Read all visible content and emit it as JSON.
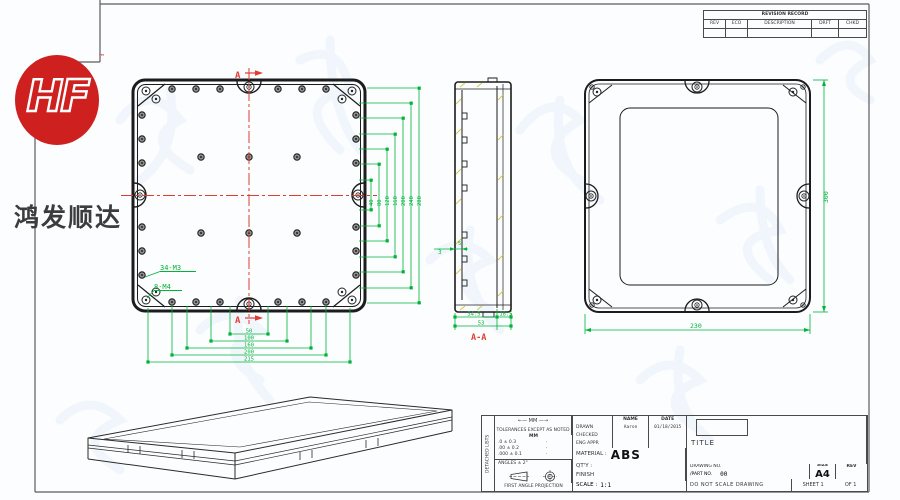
{
  "logo": {
    "brand_text": "HF",
    "brand_tm": "™",
    "company_name_cn": "鸿发顺达",
    "brand_color": "#cf2020"
  },
  "colors": {
    "dimension_green": "#00b339",
    "centerline_red": "#e23b32",
    "hatch_yellow": "#d6ca3c",
    "line_black": "#1c1c1c"
  },
  "revision_table": {
    "title": "REVISION RECORD",
    "columns": [
      "REV",
      "ECO",
      "DESCRIPTION",
      "DRFT",
      "CHKD"
    ]
  },
  "views": {
    "top": {
      "section_marker_top": "A",
      "section_marker_bottom": "A",
      "thread_note_1": "34-M3",
      "thread_note_2": "8-M4",
      "right_dims": [
        "40",
        "80",
        "120",
        "160",
        "200",
        "240",
        "280"
      ],
      "bottom_dims": [
        "50",
        "100",
        "160",
        "200",
        "215"
      ]
    },
    "section": {
      "label": "A-A",
      "dim_boss": "5",
      "dim_wall": "3",
      "dim_body": "34.5",
      "dim_lid": "18.5",
      "dim_total": "53"
    },
    "back": {
      "dim_width": "230",
      "dim_height": "300"
    }
  },
  "title_block": {
    "side_strip": "DETACHED LISTS",
    "units_arrow_label": "←— MM —→",
    "tolerance_note": "TOLERANCES EXCEPT AS NOTED",
    "tol_unit_header": "MM",
    "tolerances": [
      ".0 ± 0.3",
      ".00 ± 0.2",
      ".000 ± 0.1"
    ],
    "tol_marks": [
      "·",
      "·",
      "·"
    ],
    "angles_note": "ANGLES ± 2°",
    "projection_label": "FIRST ANGLE PROJECTION",
    "name_header": "NAME",
    "date_header": "DATE",
    "drawn_label": "DRAWN",
    "drawn_name": "Aaron",
    "drawn_date": "01/18/2015",
    "checked_label": "CHECKED",
    "eng_appr_label": "ENG APPR",
    "material_label": "MATERIAL :",
    "material_value": "ABS",
    "qty_label": "QT'Y :",
    "finish_label": "FINISH",
    "scale_label": "SCALE :",
    "scale_value": "1:1",
    "title_label": "TITLE",
    "drawing_no_label": "DRAWING NO.",
    "part_no_label": "/PART NO.",
    "part_no_value": "00",
    "size_label": "SIZE",
    "size_value": "A4",
    "rev_label": "REV",
    "no_scale_note": "DO NOT SCALE DRAWING",
    "sheet_label": "SHEET 1",
    "of_label": "OF 1"
  }
}
